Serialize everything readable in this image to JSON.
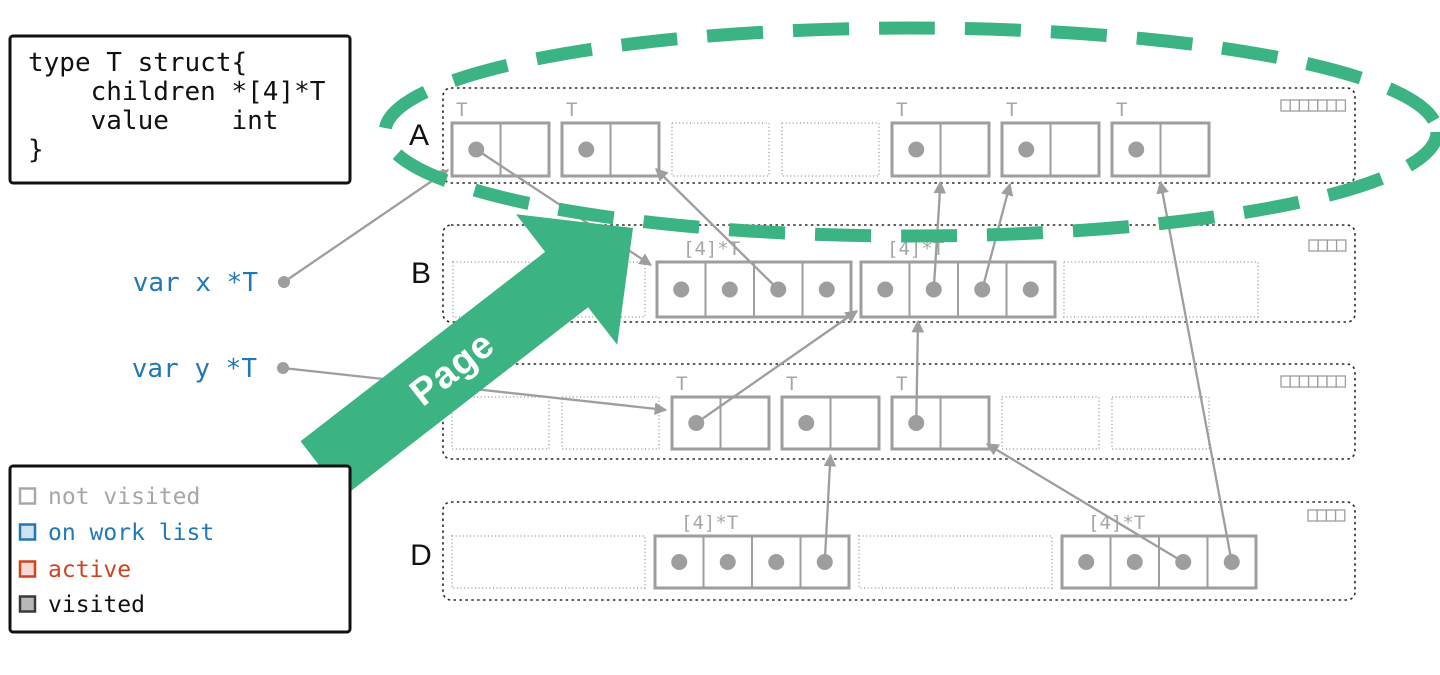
{
  "colors": {
    "green": "#3cb382",
    "blue": "#2278b5",
    "red": "#cc4423",
    "gray": "#9e9e9e",
    "black": "#111111"
  },
  "code_box": {
    "lines": [
      "type T struct{",
      "    children *[4]*T",
      "    value    int",
      "}"
    ]
  },
  "roots": [
    {
      "id": "x",
      "label": "var x *T"
    },
    {
      "id": "y",
      "label": "var y *T"
    }
  ],
  "callout": {
    "label": "Page"
  },
  "legend": {
    "items": [
      {
        "label": "not visited",
        "swatch_stroke": "#a8a8a8",
        "swatch_fill": "#ffffff",
        "text_color": "#a6a6a6"
      },
      {
        "label": "on work list",
        "swatch_stroke": "#2278b5",
        "swatch_fill": "#cfe3f2",
        "text_color": "#2278b5"
      },
      {
        "label": "active",
        "swatch_stroke": "#cc4423",
        "swatch_fill": "#f6d9d2",
        "text_color": "#cc4423"
      },
      {
        "label": "visited",
        "swatch_stroke": "#3a3a3a",
        "swatch_fill": "#b9b9b9",
        "text_color": "#111111"
      }
    ]
  },
  "pages": [
    {
      "id": "A",
      "label": "A",
      "mark_bits": 7,
      "slots": [
        {
          "kind": "object",
          "type_label": "T",
          "cells": 2,
          "pointers": [
            0
          ]
        },
        {
          "kind": "object",
          "type_label": "T",
          "cells": 2,
          "pointers": [
            0
          ]
        },
        {
          "kind": "free"
        },
        {
          "kind": "free"
        },
        {
          "kind": "object",
          "type_label": "T",
          "cells": 2,
          "pointers": [
            0
          ]
        },
        {
          "kind": "object",
          "type_label": "T",
          "cells": 2,
          "pointers": [
            0
          ]
        },
        {
          "kind": "object",
          "type_label": "T",
          "cells": 2,
          "pointers": [
            0
          ]
        }
      ]
    },
    {
      "id": "B",
      "label": "B",
      "mark_bits": 4,
      "slots": [
        {
          "kind": "free"
        },
        {
          "kind": "object",
          "type_label": "[4]*T",
          "cells": 4,
          "pointers": [
            0,
            1,
            2,
            3
          ]
        },
        {
          "kind": "object",
          "type_label": "[4]*T",
          "cells": 4,
          "pointers": [
            0,
            1,
            2,
            3
          ]
        },
        {
          "kind": "free"
        }
      ]
    },
    {
      "id": "C",
      "label": "",
      "mark_bits": 7,
      "slots": [
        {
          "kind": "free"
        },
        {
          "kind": "free"
        },
        {
          "kind": "object",
          "type_label": "T",
          "cells": 2,
          "pointers": [
            0
          ]
        },
        {
          "kind": "object",
          "type_label": "T",
          "cells": 2,
          "pointers": [
            0
          ]
        },
        {
          "kind": "object",
          "type_label": "T",
          "cells": 2,
          "pointers": [
            0
          ]
        },
        {
          "kind": "free"
        },
        {
          "kind": "free"
        }
      ]
    },
    {
      "id": "D",
      "label": "D",
      "mark_bits": 4,
      "slots": [
        {
          "kind": "free"
        },
        {
          "kind": "object",
          "type_label": "[4]*T",
          "cells": 4,
          "pointers": [
            0,
            1,
            2,
            3
          ]
        },
        {
          "kind": "free"
        },
        {
          "kind": "object",
          "type_label": "[4]*T",
          "cells": 4,
          "pointers": [
            0,
            1,
            2,
            3
          ]
        }
      ]
    }
  ],
  "references": [
    {
      "from": "root:x",
      "to": "A:0",
      "anchor": "corner-bl"
    },
    {
      "from": "root:y",
      "to": "C:2",
      "anchor": "left"
    },
    {
      "from": "A:0:0",
      "to": "B:1",
      "anchor": "top-left"
    },
    {
      "from": "B:1:2",
      "to": "A:1",
      "anchor": "bottom-right"
    },
    {
      "from": "B:2:1",
      "to": "A:4",
      "anchor": "bottom"
    },
    {
      "from": "B:2:2",
      "to": "A:5",
      "anchor": "bottom-left-out"
    },
    {
      "from": "C:2:0",
      "to": "B:2",
      "anchor": "corner-bl"
    },
    {
      "from": "C:4:0",
      "to": "B:2",
      "anchor": "bottom-mid"
    },
    {
      "from": "D:1:3",
      "to": "C:3",
      "anchor": "bottom"
    },
    {
      "from": "D:3:2",
      "to": "C:4",
      "anchor": "corner-br"
    },
    {
      "from": "D:3:3",
      "to": "A:6",
      "anchor": "bottom"
    }
  ]
}
